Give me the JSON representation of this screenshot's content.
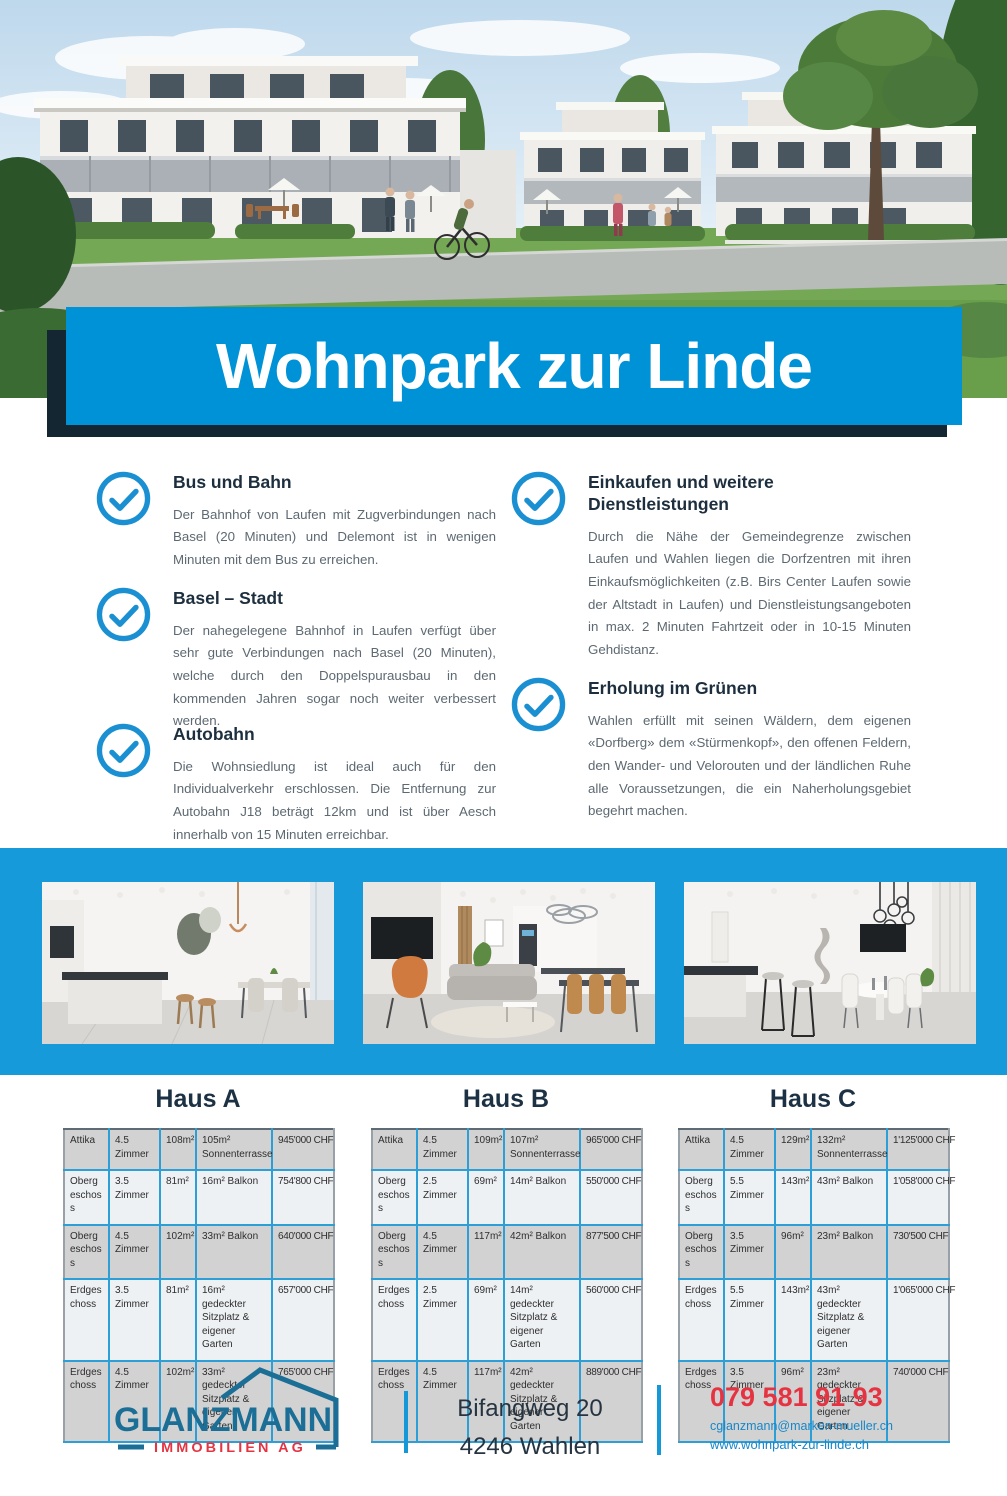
{
  "banner": {
    "title": "Wohnpark zur Linde"
  },
  "features": {
    "left": [
      {
        "title": "Bus und Bahn",
        "body": "Der Bahnhof von Laufen mit Zugverbindungen nach Basel (20 Minuten) und Delemont ist in wenigen Minuten mit dem Bus zu erreichen."
      },
      {
        "title": "Basel – Stadt",
        "body": "Der nahegelegene Bahnhof in Laufen verfügt über sehr gute Verbindungen nach Basel (20 Minuten), welche durch den Doppelspurausbau in den kommenden Jahren sogar noch weiter verbessert werden."
      },
      {
        "title": "Autobahn",
        "body": "Die Wohnsiedlung ist ideal auch für den Individualverkehr erschlossen. Die Entfernung zur Autobahn J18 beträgt 12km und ist über Aesch innerhalb von 15 Minuten erreichbar."
      }
    ],
    "right": [
      {
        "title": "Einkaufen und weitere Dienstleistungen",
        "body": "Durch die Nähe der Gemeindegrenze zwischen Laufen und Wahlen liegen die Dorfzentren mit ihren Einkaufsmöglichkeiten (z.B. Birs Center Laufen sowie der Altstadt in Laufen) und Dienstleistungsangeboten in max. 2 Minuten Fahrtzeit oder in 10-15 Minuten Gehdistanz."
      },
      {
        "title": "Erholung im Grünen",
        "body": "Wahlen erfüllt mit seinen Wäldern, dem eigenen «Dorfberg» dem «Stürmenkopf», den offenen Feldern, den Wander- und Velorouten und der ländlichen Ruhe alle Voraussetzungen, die ein Naherholungsgebiet begehrt machen."
      }
    ]
  },
  "houses": [
    {
      "name": "Haus A",
      "rows": [
        [
          "Attika",
          "4.5 Zimmer",
          "108m²",
          "105m² Sonnenterrasse",
          "945'000 CHF"
        ],
        [
          "Obergeschoss",
          "3.5 Zimmer",
          "81m²",
          "16m² Balkon",
          "754'800 CHF"
        ],
        [
          "Obergeschoss",
          "4.5 Zimmer",
          "102m²",
          "33m² Balkon",
          "640'000 CHF"
        ],
        [
          "Erdgeschoss",
          "3.5 Zimmer",
          "81m²",
          "16m² gedeckter Sitzplatz & eigener Garten",
          "657'000 CHF"
        ],
        [
          "Erdgeschoss",
          "4.5 Zimmer",
          "102m²",
          "33m² gedeckter Sitzplatz & eigener Garten",
          "765'000 CHF"
        ]
      ]
    },
    {
      "name": "Haus B",
      "rows": [
        [
          "Attika",
          "4.5 Zimmer",
          "109m²",
          "107m² Sonnenterrasse",
          "965'000 CHF"
        ],
        [
          "Obergeschoss",
          "2.5 Zimmer",
          "69m²",
          "14m² Balkon",
          "550'000 CHF"
        ],
        [
          "Obergeschoss",
          "4.5 Zimmer",
          "117m²",
          "42m² Balkon",
          "877'500 CHF"
        ],
        [
          "Erdgeschoss",
          "2.5 Zimmer",
          "69m²",
          "14m² gedeckter Sitzplatz & eigener Garten",
          "560'000 CHF"
        ],
        [
          "Erdgeschoss",
          "4.5 Zimmer",
          "117m²",
          "42m² gedeckter Sitzplatz & eigener Garten",
          "889'000 CHF"
        ]
      ]
    },
    {
      "name": "Haus C",
      "rows": [
        [
          "Attika",
          "4.5 Zimmer",
          "129m²",
          "132m² Sonnenterrasse",
          "1'125'000 CHF"
        ],
        [
          "Obergeschoss",
          "5.5 Zimmer",
          "143m²",
          "43m² Balkon",
          "1'058'000 CHF"
        ],
        [
          "Obergeschoss",
          "3.5 Zimmer",
          "96m²",
          "23m² Balkon",
          "730'500 CHF"
        ],
        [
          "Erdgeschoss",
          "5.5 Zimmer",
          "143m²",
          "43m² gedeckter Sitzplatz & eigener Garten",
          "1'065'000 CHF"
        ],
        [
          "Erdgeschoss",
          "3.5 Zimmer",
          "96m²",
          "23m² gedeckter Sitzplatz & eigener Garten",
          "740'000 CHF"
        ]
      ]
    }
  ],
  "footer": {
    "logo_name": "GLANZMANN",
    "logo_subtitle": "IMMOBILIEN AG",
    "address_line1": "Bifangweg 20",
    "address_line2": "4246 Wahlen",
    "phone": "079 581 91 93",
    "email": "cglanzmann@marken-mueller.ch",
    "website": "www.wohnpark-zur-linde.ch"
  },
  "colors": {
    "banner_blue": "#0092d6",
    "band_blue": "#179ad9",
    "dark_navy": "#132631",
    "check_blue": "#1a8fd1",
    "table_border_blue": "#2b9fd6",
    "table_row_grey": "#d2d2d2",
    "table_row_light": "#eef1f4",
    "logo_teal": "#1b6e96",
    "logo_red": "#e63341",
    "phone_red": "#e63341",
    "link_blue": "#1787c9"
  }
}
